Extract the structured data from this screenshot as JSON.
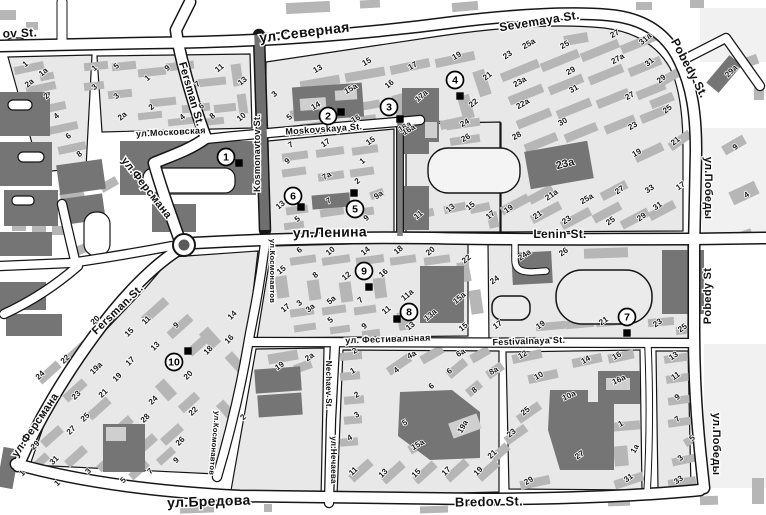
{
  "map": {
    "palette": {
      "road": "#ffffff",
      "block": "#e8e8e8",
      "building_medium": "#b6b6b6",
      "building_dark": "#757575",
      "outline": "#151515",
      "background": "#ffffff"
    },
    "street_labels": [
      {
        "text": "ov St.",
        "x": 20,
        "y": 37,
        "rot": -2,
        "size": 12
      },
      {
        "text": "ул.Северная",
        "x": 305,
        "y": 37,
        "rot": -7,
        "size": 14
      },
      {
        "text": "Sevemaya St.",
        "x": 540,
        "y": 25,
        "rot": -9,
        "size": 12
      },
      {
        "text": "Pobedy St.",
        "x": 686,
        "y": 70,
        "rot": 62,
        "size": 12
      },
      {
        "text": "ул.Победы",
        "x": 705,
        "y": 188,
        "rot": 90,
        "size": 11
      },
      {
        "text": "Pobedy St",
        "x": 711,
        "y": 296,
        "rot": -90,
        "size": 11
      },
      {
        "text": "ул.Победы",
        "x": 713,
        "y": 444,
        "rot": 90,
        "size": 11
      },
      {
        "text": "Fersman St.",
        "x": 188,
        "y": 95,
        "rot": 74,
        "size": 11
      },
      {
        "text": "ул.Ферсмана",
        "x": 144,
        "y": 190,
        "rot": 52,
        "size": 11
      },
      {
        "text": "Kosmonavtov St.",
        "x": 260,
        "y": 153,
        "rot": -90,
        "size": 9
      },
      {
        "text": "ул.Московская",
        "x": 171,
        "y": 135,
        "rot": -3,
        "size": 9
      },
      {
        "text": "Moskovskaya St.",
        "x": 324,
        "y": 132,
        "rot": -4,
        "size": 9
      },
      {
        "text": "ул.Ленина",
        "x": 330,
        "y": 237,
        "rot": -1,
        "size": 14
      },
      {
        "text": "Lenin St.",
        "x": 560,
        "y": 238,
        "rot": 0,
        "size": 12
      },
      {
        "text": "ул.Космонавтов",
        "x": 270,
        "y": 271,
        "rot": 90,
        "size": 7.5
      },
      {
        "text": "ул.Космонавтов",
        "x": 212,
        "y": 443,
        "rot": 95,
        "size": 7.5
      },
      {
        "text": "Nechaev St.",
        "x": 326,
        "y": 385,
        "rot": 90,
        "size": 8
      },
      {
        "text": "ул.Нечаева",
        "x": 331,
        "y": 460,
        "rot": 90,
        "size": 8
      },
      {
        "text": "ул. Фестивальная",
        "x": 388,
        "y": 342,
        "rot": -2,
        "size": 9
      },
      {
        "text": "Festivalnaya St.",
        "x": 529,
        "y": 344,
        "rot": -2,
        "size": 9
      },
      {
        "text": "ул.Ферсмана",
        "x": 38,
        "y": 427,
        "rot": -56,
        "size": 11
      },
      {
        "text": "Fersman St.",
        "x": 120,
        "y": 312,
        "rot": -44,
        "size": 11
      },
      {
        "text": "ул.Бредова",
        "x": 209,
        "y": 506,
        "rot": -2,
        "size": 14
      },
      {
        "text": "Bredov St.",
        "x": 489,
        "y": 506,
        "rot": -1,
        "size": 13
      }
    ],
    "poi_markers": [
      {
        "num": "1",
        "x": 226,
        "y": 157,
        "sqx": 239,
        "sqy": 163
      },
      {
        "num": "2",
        "x": 328,
        "y": 116,
        "sqx": 341,
        "sqy": 112
      },
      {
        "num": "3",
        "x": 389,
        "y": 107,
        "sqx": 400,
        "sqy": 119
      },
      {
        "num": "4",
        "x": 455,
        "y": 80,
        "sqx": 460,
        "sqy": 96
      },
      {
        "num": "5",
        "x": 355,
        "y": 209,
        "sqx": 354,
        "sqy": 193
      },
      {
        "num": "6",
        "x": 293,
        "y": 196,
        "sqx": 301,
        "sqy": 207
      },
      {
        "num": "7",
        "x": 627,
        "y": 317,
        "sqx": 627,
        "sqy": 333
      },
      {
        "num": "8",
        "x": 409,
        "y": 312,
        "sqx": 397,
        "sqy": 319
      },
      {
        "num": "9",
        "x": 364,
        "y": 271,
        "sqx": 369,
        "sqy": 287
      },
      {
        "num": "10",
        "x": 174,
        "y": 362,
        "sqx": 188,
        "sqy": 351
      }
    ],
    "building_numbers": [
      [
        "1",
        27,
        66,
        -40
      ],
      [
        "1a",
        45,
        74,
        -40
      ],
      [
        "2a",
        31,
        85,
        -40
      ],
      [
        "2",
        48,
        98,
        -40
      ],
      [
        "4",
        58,
        118,
        -40
      ],
      [
        "6",
        70,
        138,
        -40
      ],
      [
        "8",
        81,
        156,
        -40
      ],
      [
        "1",
        96,
        70,
        -40
      ],
      [
        "5",
        118,
        68,
        -40
      ],
      [
        "3",
        96,
        89,
        -40
      ],
      [
        "3",
        118,
        98,
        -40
      ],
      [
        "1",
        149,
        80,
        -40
      ],
      [
        "9",
        169,
        70,
        -40
      ],
      [
        "7",
        199,
        86,
        -40
      ],
      [
        "2",
        153,
        109,
        -40
      ],
      [
        "2a",
        124,
        118,
        -40
      ],
      [
        "6",
        203,
        108,
        -40
      ],
      [
        "4",
        184,
        119,
        -40
      ],
      [
        "8",
        214,
        118,
        -40
      ],
      [
        "10",
        243,
        119,
        -40
      ],
      [
        "11",
        221,
        70,
        -40
      ],
      [
        "13",
        244,
        83,
        -40
      ],
      [
        "3",
        276,
        96,
        -40
      ],
      [
        "13",
        319,
        71,
        -30
      ],
      [
        "15",
        368,
        64,
        -30
      ],
      [
        "17",
        414,
        68,
        -30
      ],
      [
        "19",
        458,
        58,
        -30
      ],
      [
        "21",
        489,
        78,
        -40
      ],
      [
        "14",
        317,
        108,
        -30
      ],
      [
        "15a",
        352,
        91,
        -30
      ],
      [
        "16",
        391,
        86,
        -40
      ],
      [
        "17a",
        423,
        98,
        -40
      ],
      [
        "5",
        291,
        119,
        -40
      ],
      [
        "16",
        357,
        121,
        -30
      ],
      [
        "22",
        475,
        105,
        -40
      ],
      [
        "24",
        466,
        125,
        -30
      ],
      [
        "16a",
        406,
        129,
        -30
      ],
      [
        "23",
        509,
        57,
        -35
      ],
      [
        "25a",
        530,
        46,
        -30
      ],
      [
        "25",
        566,
        47,
        -30
      ],
      [
        "27",
        616,
        36,
        -30
      ],
      [
        "27a",
        619,
        61,
        -30
      ],
      [
        "31a",
        647,
        41,
        -40
      ],
      [
        "31",
        651,
        64,
        -40
      ],
      [
        "29",
        663,
        81,
        -40
      ],
      [
        "27",
        631,
        98,
        -30
      ],
      [
        "25",
        669,
        111,
        -40
      ],
      [
        "23",
        634,
        128,
        -30
      ],
      [
        "23a",
        521,
        84,
        -30
      ],
      [
        "22a",
        524,
        106,
        -30
      ],
      [
        "29",
        572,
        73,
        -30
      ],
      [
        "31",
        575,
        91,
        -30
      ],
      [
        "30",
        564,
        124,
        -30
      ],
      [
        "28",
        518,
        138,
        -30
      ],
      [
        "29a",
        733,
        73,
        -45
      ],
      [
        "23a",
        566,
        167,
        -15,
        11,
        "#e2e2e2"
      ],
      [
        "19",
        510,
        211,
        -35
      ],
      [
        "21",
        539,
        217,
        -35
      ],
      [
        "21a",
        553,
        197,
        -35
      ],
      [
        "23",
        568,
        222,
        -35
      ],
      [
        "25a",
        588,
        201,
        -30
      ],
      [
        "25",
        612,
        223,
        -35
      ],
      [
        "29",
        643,
        219,
        -35
      ],
      [
        "31",
        659,
        208,
        -35
      ],
      [
        "33",
        651,
        191,
        -35
      ],
      [
        "27",
        621,
        192,
        -35
      ],
      [
        "17",
        682,
        188,
        -35
      ],
      [
        "19",
        638,
        155,
        -30
      ],
      [
        "21",
        677,
        143,
        -40
      ],
      [
        "9",
        737,
        149,
        -40
      ],
      [
        "4",
        748,
        197,
        -35
      ],
      [
        "7",
        292,
        147,
        -30
      ],
      [
        "17",
        327,
        145,
        -35
      ],
      [
        "15",
        372,
        143,
        -35
      ],
      [
        "9",
        289,
        163,
        -40
      ],
      [
        "1",
        364,
        163,
        -40
      ],
      [
        "7a",
        328,
        178,
        -30
      ],
      [
        "2",
        359,
        183,
        -40
      ],
      [
        "11",
        297,
        202,
        -40
      ],
      [
        "13",
        282,
        207,
        -40
      ],
      [
        "5",
        299,
        221,
        -40
      ],
      [
        "7",
        330,
        203,
        -30
      ],
      [
        "9",
        368,
        220,
        -40
      ],
      [
        "9a",
        380,
        197,
        -35
      ],
      [
        "16a",
        410,
        132,
        -30
      ],
      [
        "26",
        467,
        140,
        -30
      ],
      [
        "11",
        420,
        217,
        -40
      ],
      [
        "13",
        452,
        210,
        -40
      ],
      [
        "15",
        472,
        208,
        -40
      ],
      [
        "17",
        492,
        217,
        -40
      ],
      [
        "6",
        301,
        252,
        -40
      ],
      [
        "10",
        332,
        253,
        -40
      ],
      [
        "14",
        367,
        253,
        -40
      ],
      [
        "18",
        400,
        252,
        -40
      ],
      [
        "20",
        432,
        253,
        -40
      ],
      [
        "22",
        468,
        261,
        -40
      ],
      [
        "15",
        283,
        272,
        -40
      ],
      [
        "8",
        317,
        277,
        -40
      ],
      [
        "12",
        348,
        278,
        -40
      ],
      [
        "16",
        385,
        275,
        -40
      ],
      [
        "17",
        287,
        310,
        -40
      ],
      [
        "3",
        301,
        305,
        -40
      ],
      [
        "3a",
        312,
        310,
        -40
      ],
      [
        "5a",
        333,
        302,
        -40
      ],
      [
        "5",
        332,
        322,
        -40
      ],
      [
        "7",
        362,
        302,
        -40
      ],
      [
        "9",
        366,
        328,
        -40
      ],
      [
        "11",
        388,
        312,
        -40
      ],
      [
        "11a",
        409,
        297,
        -40
      ],
      [
        "13a",
        432,
        317,
        -40
      ],
      [
        "13",
        412,
        328,
        -40
      ],
      [
        "15a",
        461,
        300,
        -40
      ],
      [
        "15",
        465,
        329,
        -40
      ],
      [
        "24a",
        526,
        257,
        -35
      ],
      [
        "26",
        565,
        254,
        -35
      ],
      [
        "24",
        496,
        282,
        -35
      ],
      [
        "17",
        499,
        327,
        -35
      ],
      [
        "19",
        542,
        327,
        -35
      ],
      [
        "21",
        605,
        323,
        -35
      ],
      [
        "23",
        659,
        325,
        -35
      ],
      [
        "25",
        684,
        330,
        -35
      ],
      [
        "20",
        97,
        322,
        -45
      ],
      [
        "22",
        67,
        361,
        -45
      ],
      [
        "24",
        42,
        377,
        -45
      ],
      [
        "19a",
        98,
        370,
        -45
      ],
      [
        "23",
        78,
        397,
        -45
      ],
      [
        "21",
        105,
        395,
        -45
      ],
      [
        "25",
        87,
        419,
        -45
      ],
      [
        "27",
        73,
        432,
        -45
      ],
      [
        "29",
        37,
        447,
        -45
      ],
      [
        "31",
        56,
        462,
        -45
      ],
      [
        "1",
        24,
        475,
        -45
      ],
      [
        "1",
        59,
        485,
        -45
      ],
      [
        "3",
        90,
        473,
        -45
      ],
      [
        "5",
        125,
        482,
        -45
      ],
      [
        "7",
        152,
        473,
        -45
      ],
      [
        "9",
        178,
        462,
        -45
      ],
      [
        "26",
        182,
        443,
        -45
      ],
      [
        "28",
        147,
        420,
        -45
      ],
      [
        "24",
        155,
        402,
        -45
      ],
      [
        "22",
        195,
        413,
        -45
      ],
      [
        "20",
        190,
        377,
        -45
      ],
      [
        "18",
        210,
        352,
        -45
      ],
      [
        "16",
        231,
        341,
        -45
      ],
      [
        "14",
        234,
        317,
        -45
      ],
      [
        "11",
        148,
        322,
        -45
      ],
      [
        "15",
        131,
        334,
        -45
      ],
      [
        "13",
        157,
        348,
        -45
      ],
      [
        "17",
        132,
        363,
        -45
      ],
      [
        "19",
        119,
        379,
        -45
      ],
      [
        "9",
        178,
        327,
        -45
      ],
      [
        "2",
        245,
        419,
        -45
      ],
      [
        "19",
        281,
        368,
        -35
      ],
      [
        "2a",
        311,
        359,
        -35
      ],
      [
        "2",
        356,
        353,
        -30
      ],
      [
        "1",
        354,
        373,
        -30
      ],
      [
        "2",
        358,
        397,
        -30
      ],
      [
        "3",
        358,
        417,
        -30
      ],
      [
        "4",
        351,
        440,
        -30
      ],
      [
        "4",
        398,
        372,
        -40
      ],
      [
        "4a",
        413,
        357,
        -30
      ],
      [
        "6",
        433,
        388,
        -40
      ],
      [
        "6",
        451,
        373,
        -40
      ],
      [
        "6a",
        462,
        355,
        -30
      ],
      [
        "8",
        476,
        392,
        -40
      ],
      [
        "8a",
        495,
        373,
        -30
      ],
      [
        "5",
        406,
        425,
        -30
      ],
      [
        "19a",
        465,
        428,
        -60
      ],
      [
        "15a",
        419,
        447,
        -30
      ],
      [
        "11",
        355,
        473,
        -45
      ],
      [
        "13",
        385,
        475,
        -45
      ],
      [
        "15",
        418,
        475,
        -45
      ],
      [
        "17",
        448,
        473,
        -45
      ],
      [
        "19",
        480,
        473,
        -45
      ],
      [
        "21",
        494,
        456,
        -45
      ],
      [
        "12",
        524,
        357,
        -30
      ],
      [
        "14",
        587,
        362,
        -30
      ],
      [
        "16",
        618,
        358,
        -30
      ],
      [
        "10",
        540,
        378,
        -30
      ],
      [
        "16a",
        620,
        382,
        -25
      ],
      [
        "10a",
        570,
        398,
        -25
      ],
      [
        "25",
        527,
        413,
        -40
      ],
      [
        "23",
        513,
        435,
        -40
      ],
      [
        "1",
        622,
        426,
        -30
      ],
      [
        "27",
        581,
        457,
        -35
      ],
      [
        "1a",
        637,
        450,
        -60
      ],
      [
        "29",
        530,
        483,
        -30
      ],
      [
        "31",
        630,
        480,
        -35
      ],
      [
        "13",
        675,
        358,
        -35
      ],
      [
        "11",
        677,
        378,
        -35
      ],
      [
        "9",
        679,
        399,
        -40
      ],
      [
        "7",
        679,
        421,
        -40
      ],
      [
        "5",
        694,
        440,
        -45
      ],
      [
        "3",
        682,
        460,
        -40
      ],
      [
        "33",
        680,
        482,
        -35
      ]
    ]
  }
}
